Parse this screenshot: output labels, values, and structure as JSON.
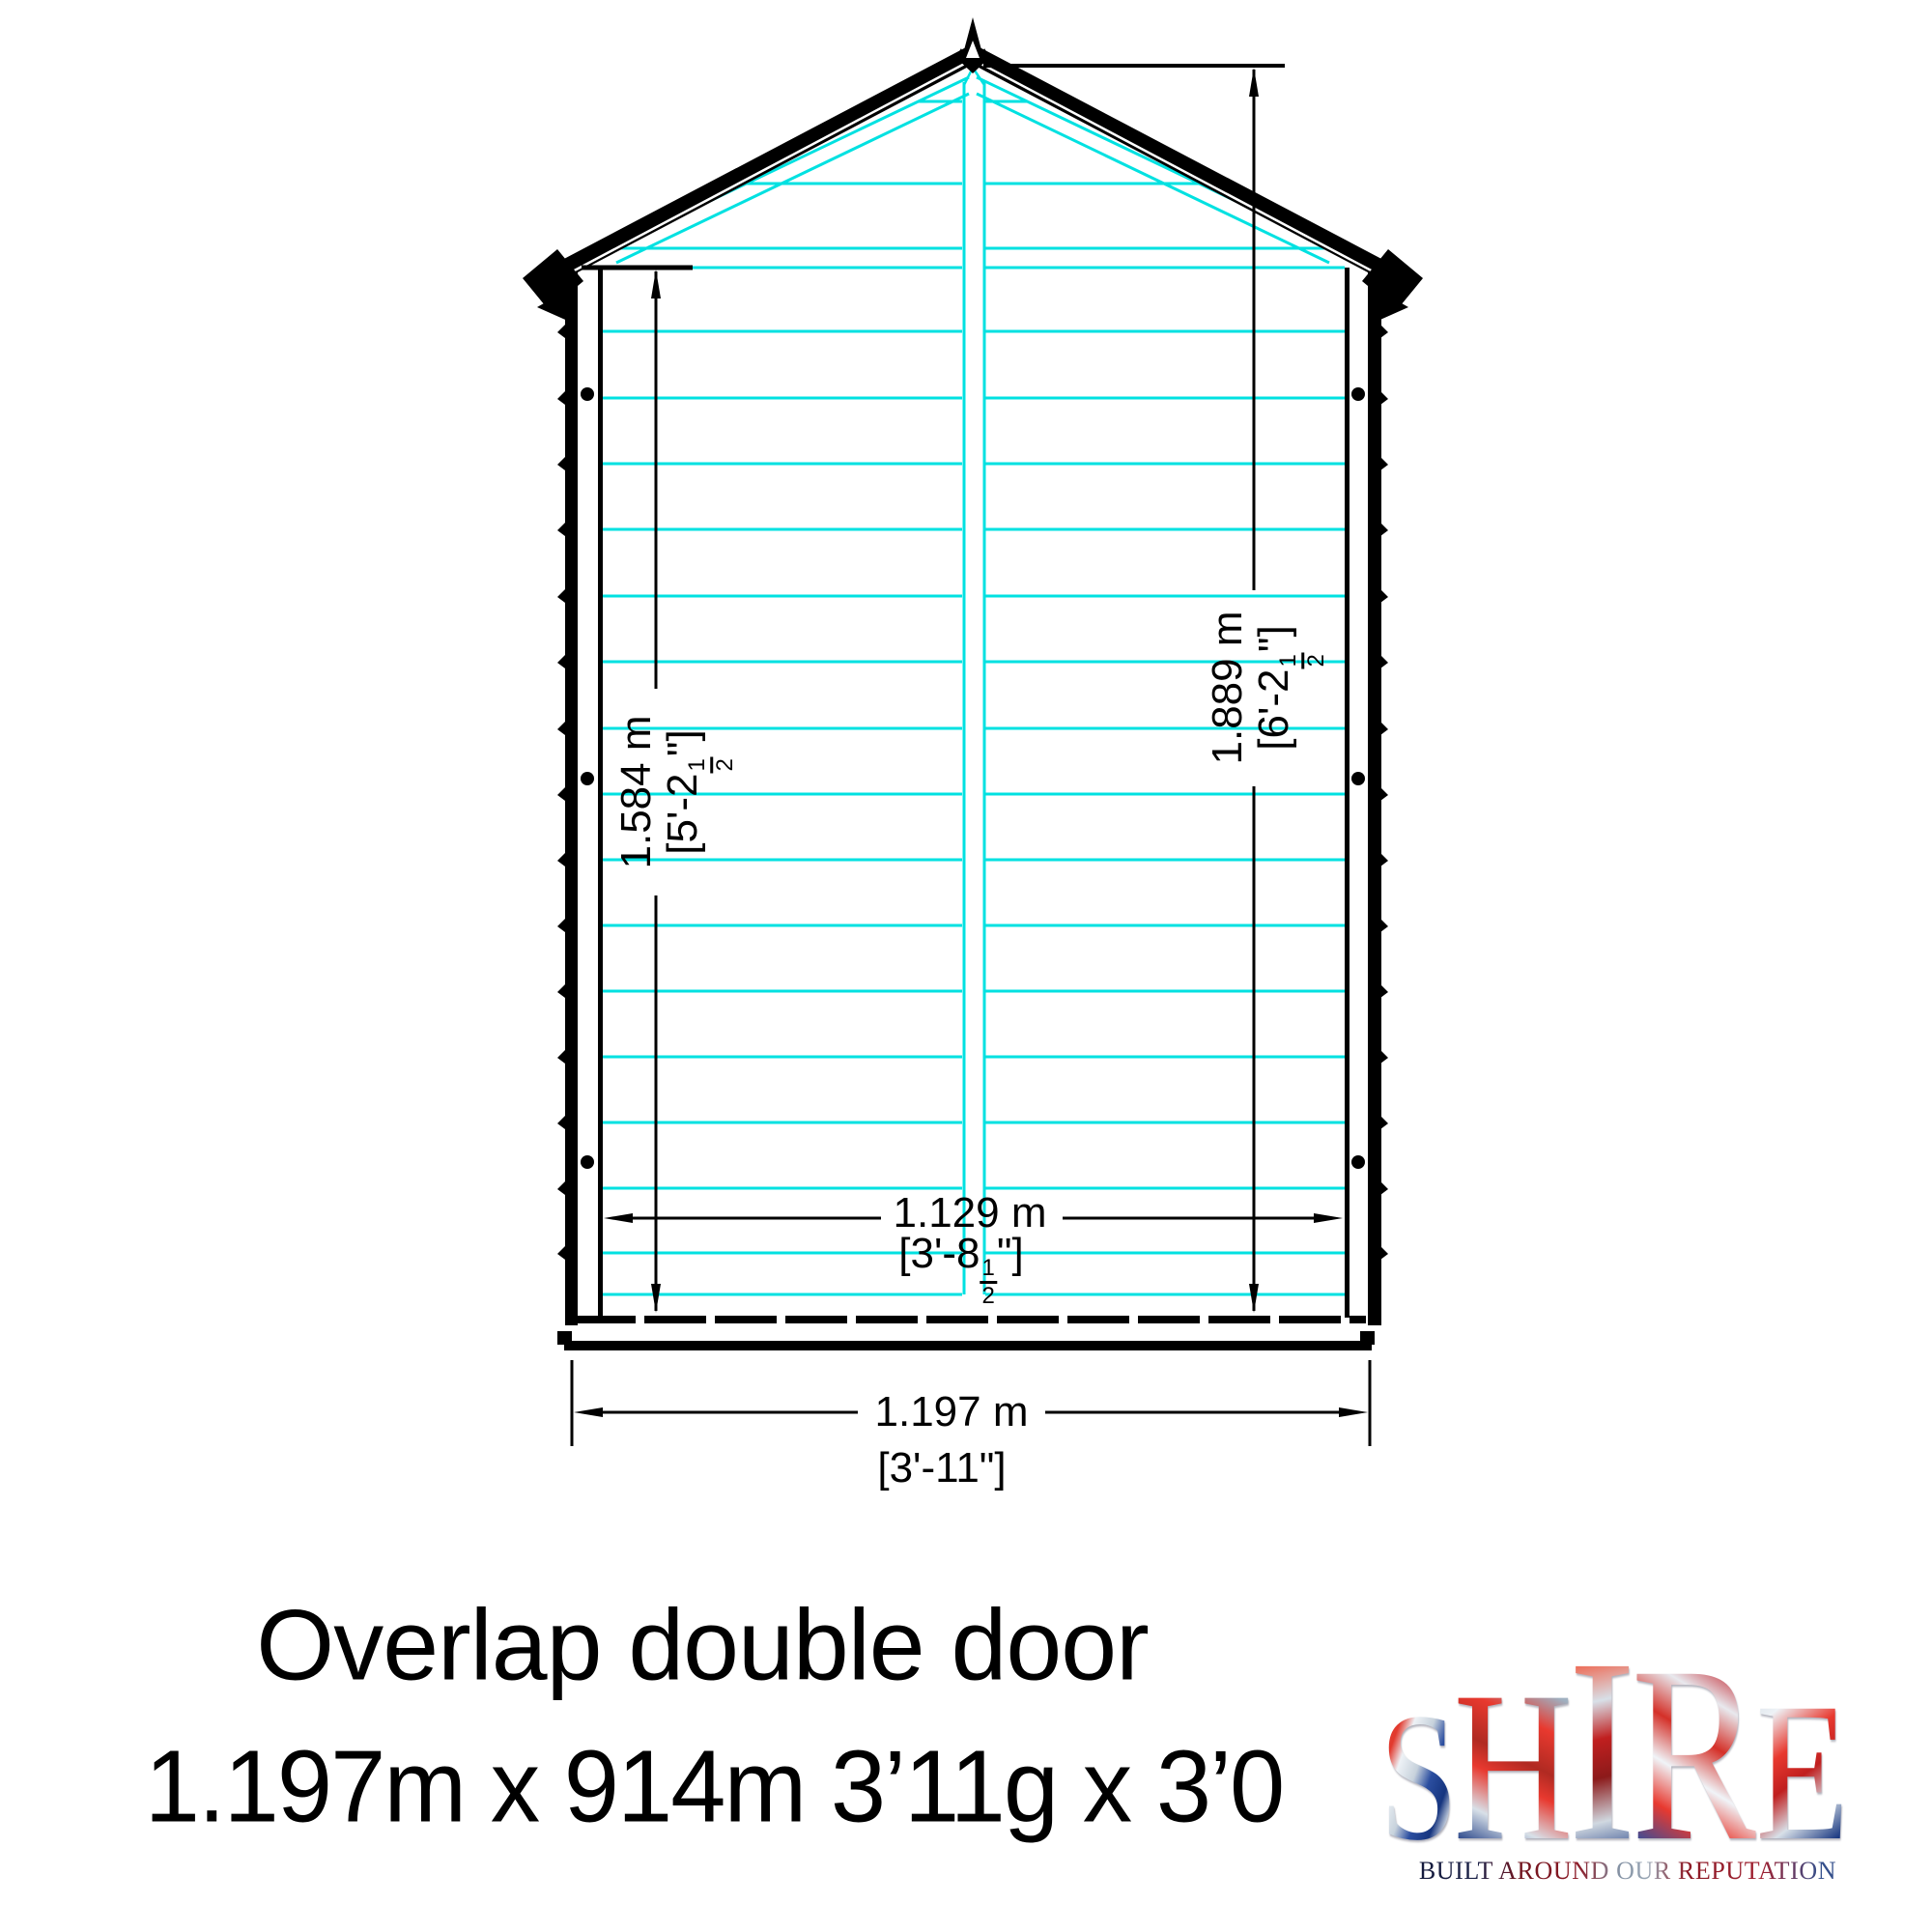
{
  "colors": {
    "cladding": "#00e1e1",
    "line": "#000000"
  },
  "dimensions": {
    "left_height": {
      "metric": "1.584 m",
      "imp_prefix": "[5'-2",
      "frac_num": "1",
      "frac_den": "2",
      "imp_suffix": "\"]"
    },
    "right_height": {
      "metric": "1.889 m",
      "imp_prefix": "[6'-2",
      "frac_num": "1",
      "frac_den": "2",
      "imp_suffix": "\"]"
    },
    "inner_width": {
      "metric": "1.129 m",
      "imp_prefix": "[3'-8",
      "frac_num": "1",
      "frac_den": "2",
      "imp_suffix": "\"]"
    },
    "outer_width": {
      "metric": "1.197 m",
      "imperial": "[3'-11\"]"
    }
  },
  "caption": {
    "line1": "Overlap double door",
    "line2": "1.197m x 914m 3’11g x 3’0"
  },
  "logo": {
    "letters": [
      "S",
      "H",
      "I",
      "R",
      "E"
    ],
    "tagline": "BUILT AROUND OUR REPUTATION"
  }
}
